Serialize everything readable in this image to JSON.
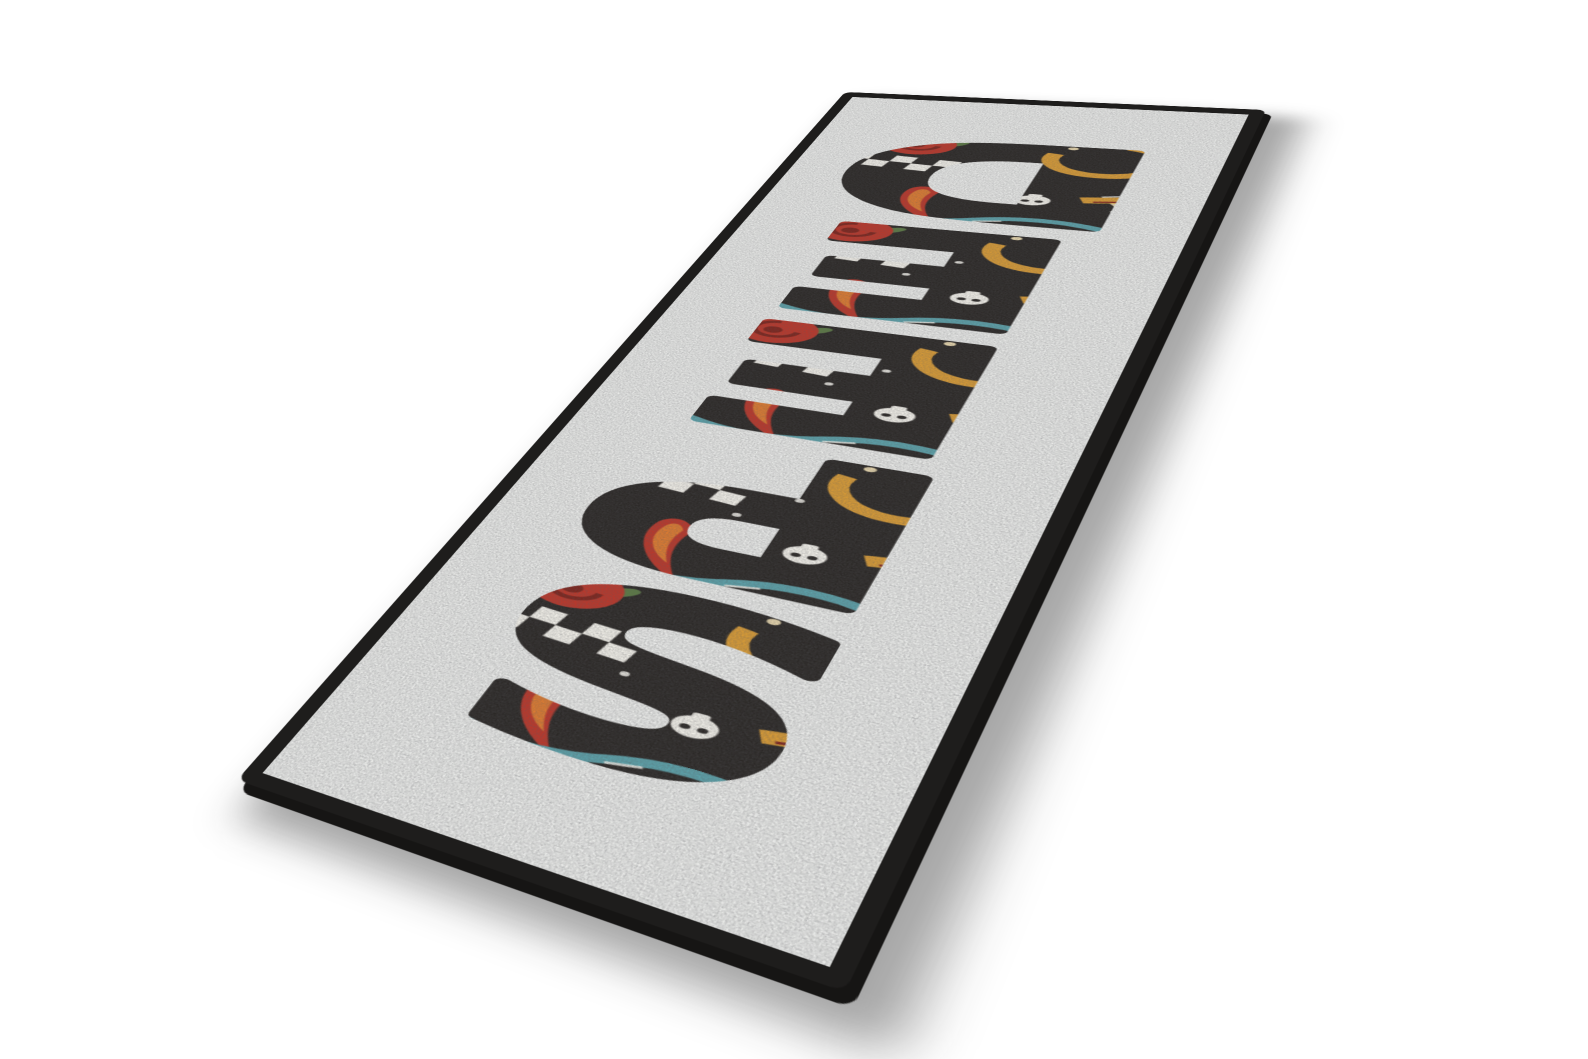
{
  "scene": {
    "background_color": "#ffffff",
    "description": "Perspective product mockup of a rectangular bar-runner floor mat lying on a white floor"
  },
  "mat": {
    "text": "SPEED",
    "letter_count": 5,
    "lettering_style": "heavy rounded letters rotated 90 degrees, filled with old-school tattoo flash artwork",
    "border_color": "#1e1d1c",
    "surface_color": "#ebecea",
    "art_text": "1984",
    "art_colors": {
      "background": "#2b2826",
      "red": "#bb372a",
      "dark_red": "#7e241c",
      "orange": "#dd7b31",
      "gold": "#d89b36",
      "teal": "#5fa7b0",
      "light_blue": "#85bcc9",
      "cream": "#e9d8ae",
      "green": "#5c7a45",
      "white": "#f3f1ea",
      "pink": "#e8a7ad"
    },
    "motifs": [
      "woman-portrait-red-scarf",
      "checkered-racing-flag",
      "red-roses",
      "blue-roses",
      "golden-horseshoe",
      "motorcycle-wheel",
      "piston",
      "flames",
      "sheriff-star",
      "skull",
      "dice",
      "bearded-biker-bandana",
      "compass-wheel",
      "hand-with-1984-tattoo",
      "stars-and-sparks",
      "teal-ribbon"
    ]
  }
}
